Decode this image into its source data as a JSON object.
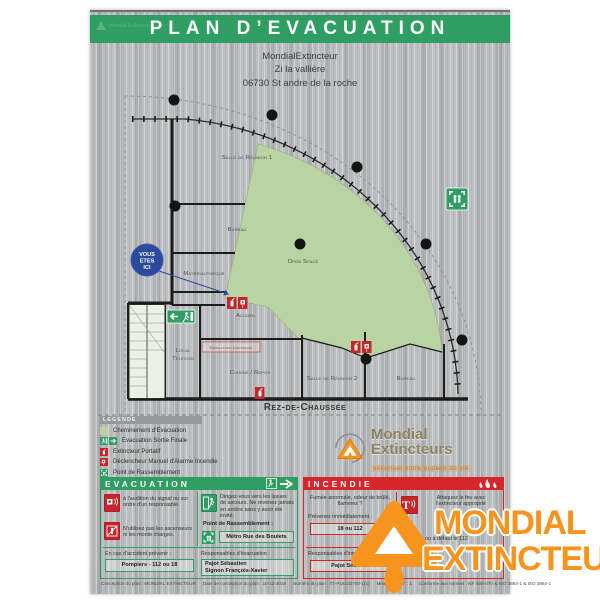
{
  "banner": {
    "title": "PLAN D’EVACUATION",
    "watermark": "Mondial Extincteurs"
  },
  "address": {
    "line1": "MondialExtincteur",
    "line2": "Zi la vallière",
    "line3": "06730 St andre de la roche"
  },
  "plan": {
    "floor_label": "Rez-de-Chaussée",
    "you_are_here": {
      "line1": "VOUS",
      "line2": "ETES",
      "line3": "ICI"
    },
    "rooms": {
      "salle_reunion_1": "Salle de Réunion 1",
      "bureau_1": "Bureau",
      "materiautheque": "Matériauthèque",
      "accueil": "Accueil",
      "open_space": "Open Space",
      "local_telecom_line1": "Local",
      "local_telecom_line2": "Telecom",
      "installation_electrique": "Installation  électrique",
      "cuisine_repos": "Cuisine / Repos",
      "salle_reunion_2": "Salle de Réunion 2",
      "bureau_2": "Bureau"
    }
  },
  "legend": {
    "header": "LEGENDE",
    "items": [
      {
        "icon": "evacuation-path-swatch",
        "label": "Cheminement d'Evacuation"
      },
      {
        "icon": "final-exit-icon",
        "label": "Evacuation Sortie Finale"
      },
      {
        "icon": "extinguisher-icon",
        "label": "Extincteur Portatif"
      },
      {
        "icon": "manual-alarm-icon",
        "label": "Déclencheur Manuel d'Alarme Incendie"
      },
      {
        "icon": "assembly-point-icon",
        "label": "Point de Rassemblement"
      }
    ]
  },
  "evacuation": {
    "title": "EVACUATION",
    "item_signal": "à l'audition du signal ou sur ordre d'un responsable.",
    "item_issues": "Dirigez-vous vers les issues de secours. Ne revenez jamais en arrière sans y avoir été invité.",
    "item_ascenseurs": "N'utilisez pas les ascenseurs ni les monte charges.",
    "assembly_label": "Point de Rassemblement :",
    "assembly_value": "Métro Rue des Boulets",
    "accident_label": "En cas d'accident prévenir :",
    "accident_value": "Pompiers - 112 ou 18",
    "resp_label": "Responsables d'évacuation :",
    "resp_line1": "Pajot Sébastien",
    "resp_line2": "Signon François-Xavier"
  },
  "incendie": {
    "title": "INCENDIE",
    "smoke_text": "Fumée anormale, odeur de brûlé, flammes ?",
    "prevent_label": "Prévenez immédiatement :",
    "prevent_value": "18 ou 112",
    "attack_text": "Attaquez le feu avec l'extincteur approprié",
    "fallback_text": "ou à défaut le 112",
    "resp_label": "Responsables d'intervention :",
    "resp_value": "Pajot Sébastien"
  },
  "footer": {
    "items": [
      "Conception du plan : MONDIAL EXTINCTEUR",
      "Date de conception du plan : 10-12-2016",
      "Numéro du plan : TT-P16122700-1(1)",
      "Mise à jour N° : 1",
      "Conforme aux normes : NF X08-070 & ISO 3864-1 & ISO 3864-1"
    ]
  },
  "brand": {
    "name": "Mondial Extincteurs",
    "tagline": "sécuriser votre espace de vie",
    "watermark_line1": "MONDIAL",
    "watermark_line2": "EXTINCTEUR"
  },
  "colors": {
    "green": "#2e9e63",
    "red": "#d6252b",
    "path_green": "#b9d3a2",
    "blue": "#2b4a9e",
    "orange": "#f7941d"
  }
}
